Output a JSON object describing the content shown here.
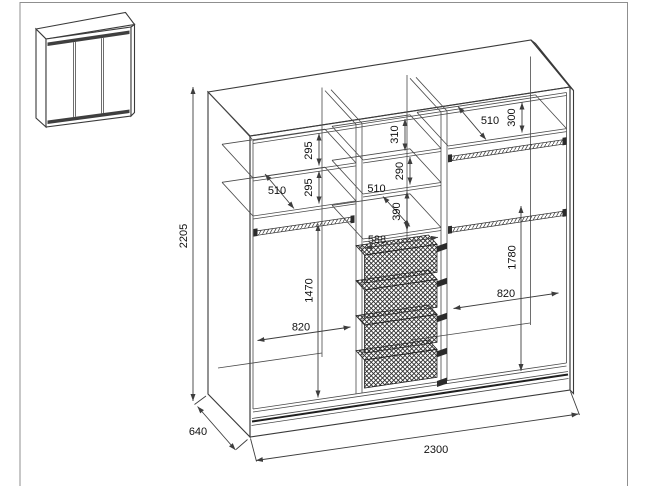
{
  "dimensions": {
    "overall": {
      "height_mm": "2205",
      "width_mm": "2300",
      "depth_mm": "640"
    },
    "left_section": {
      "top_gap": "295",
      "second_gap": "295",
      "shelf_depth": "510",
      "hanging_drop": "1470",
      "clear_width": "820"
    },
    "middle_section": {
      "top_gap": "310",
      "second_gap": "290",
      "shelf_depth": "510",
      "third_gap": "390",
      "clear_width": "588"
    },
    "right_section": {
      "shelf_depth": "510",
      "top_gap": "300",
      "hanging_drop": "1780",
      "clear_width": "820"
    }
  }
}
